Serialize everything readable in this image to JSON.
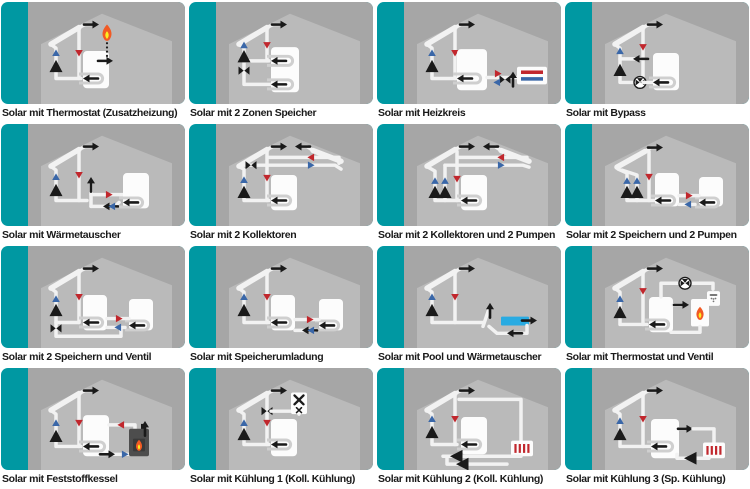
{
  "page": {
    "background": "#FFFFFF",
    "title": "Solar scheme selection grid"
  },
  "colors": {
    "teal": "#0098A2",
    "panel": "#A6A6A6",
    "house": "#BABABA",
    "pipe": "#F2F2F2",
    "tank": "#FCFCFC",
    "coil": "#CFCFCF",
    "black": "#1A1A1A",
    "blue": "#3A67A8",
    "red": "#C1272D",
    "pool": "#29ABE2",
    "flame_outer": "#F15A24",
    "flame_inner": "#FCEE21",
    "boiler": "#4D4D4D",
    "caption": "#1A1A1A"
  },
  "grid": {
    "columns": 4,
    "rows": 4
  },
  "tiles": [
    {
      "caption": "Solar mit Thermostat (Zusatzheizung)",
      "components": [
        "solar-collector",
        "pump",
        "flow-arrows",
        "storage-tank",
        "exchanger-coil",
        "thermostat-flame",
        "aux-heating-inlet"
      ]
    },
    {
      "caption": "Solar mit 2 Zonen Speicher",
      "components": [
        "solar-collector",
        "pump",
        "valve",
        "two-zone-tank",
        "upper-coil",
        "lower-coil"
      ]
    },
    {
      "caption": "Solar mit Heizkreis",
      "components": [
        "solar-collector",
        "pump",
        "storage-tank",
        "exchanger-coil",
        "mixing-valve",
        "heating-circuit-radiator"
      ]
    },
    {
      "caption": "Solar mit Bypass",
      "components": [
        "solar-collector",
        "pump",
        "bypass-line",
        "three-way-valve",
        "storage-tank",
        "exchanger-coil"
      ]
    },
    {
      "caption": "Solar mit Wärmetauscher",
      "components": [
        "solar-collector",
        "pump",
        "external-heat-exchanger",
        "storage-tank",
        "exchanger-coil"
      ]
    },
    {
      "caption": "Solar mit 2 Kollektoren",
      "components": [
        "solar-collector-left",
        "solar-collector-right",
        "valve",
        "pump",
        "storage-tank",
        "exchanger-coil"
      ]
    },
    {
      "caption": "Solar mit 2 Kollektoren und 2 Pumpen",
      "components": [
        "solar-collector-left",
        "solar-collector-right",
        "pump-1",
        "pump-2",
        "storage-tank",
        "exchanger-coil"
      ]
    },
    {
      "caption": "Solar mit 2 Speichern und 2 Pumpen",
      "components": [
        "solar-collector",
        "pump-1",
        "pump-2",
        "storage-tank-1",
        "storage-tank-2",
        "exchanger-coils"
      ]
    },
    {
      "caption": "Solar mit 2 Speichern und Ventil",
      "components": [
        "solar-collector",
        "pump",
        "switch-valve",
        "storage-tank-1",
        "storage-tank-2",
        "exchanger-coils"
      ]
    },
    {
      "caption": "Solar mit Speicherumladung",
      "components": [
        "solar-collector",
        "pump",
        "transfer-pump",
        "storage-tank-1",
        "storage-tank-2",
        "exchanger-coils"
      ]
    },
    {
      "caption": "Solar mit Pool und Wärmetauscher",
      "components": [
        "solar-collector",
        "pump",
        "external-heat-exchanger",
        "swimming-pool"
      ]
    },
    {
      "caption": "Solar mit Thermostat und Ventil",
      "components": [
        "solar-collector",
        "pump",
        "storage-tank",
        "exchanger-coil",
        "three-way-valve",
        "burner",
        "shower"
      ]
    },
    {
      "caption": "Solar mit Feststoffkessel",
      "components": [
        "solar-collector",
        "pump",
        "storage-tank",
        "exchanger-coil",
        "solid-fuel-boiler",
        "flue-arrow"
      ]
    },
    {
      "caption": "Solar mit Kühlung 1 (Koll. Kühlung)",
      "components": [
        "solar-collector",
        "pump",
        "diverter-valve",
        "cooler-box",
        "storage-tank",
        "exchanger-coil"
      ]
    },
    {
      "caption": "Solar mit Kühlung 2 (Koll. Kühlung)",
      "components": [
        "solar-collector",
        "pump",
        "cooling-loop",
        "radiator",
        "two-pumps",
        "storage-tank",
        "exchanger-coil"
      ]
    },
    {
      "caption": "Solar mit Kühlung 3 (Sp. Kühlung)",
      "components": [
        "solar-collector",
        "pump",
        "storage-tank",
        "exchanger-coil",
        "cooling-radiator",
        "circulation-pump"
      ]
    }
  ]
}
